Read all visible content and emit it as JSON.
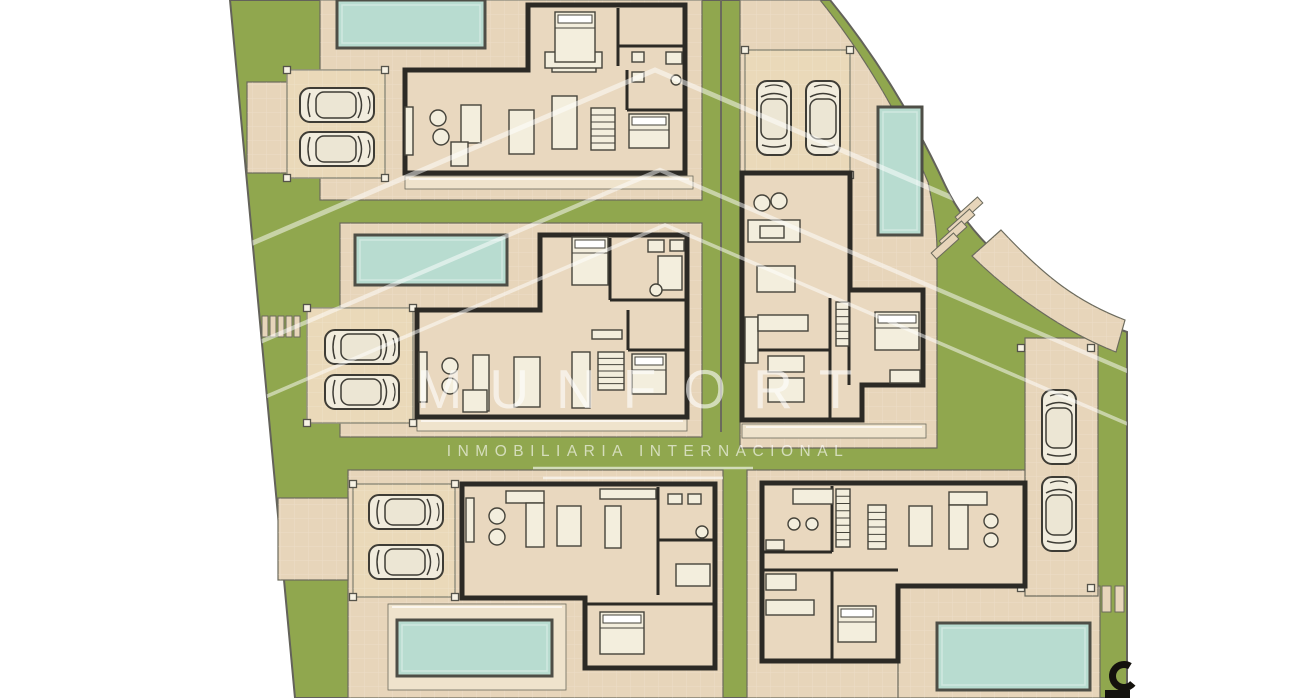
{
  "watermark": {
    "brand": "MUNFORT",
    "tagline": "INMOBILIARIA INTERNACIONAL",
    "chevrons": [
      [
        655,
        70
      ],
      [
        660,
        170
      ],
      [
        665,
        225
      ]
    ],
    "chevron_base_y": 430,
    "chevron_slope": 0.43,
    "underlines": [
      [
        533,
        468,
        753,
        468
      ],
      [
        543,
        478,
        723,
        478
      ]
    ]
  },
  "colors": {
    "white": "#ffffff",
    "lawn": "#90a74e",
    "pave": "#e7d5ba",
    "pave_light": "#efe3cc",
    "carport": "#ead9b9",
    "outline": "#6b6a5c",
    "site_edge": "#63625a",
    "wall": "#2c2a25",
    "floor": "#e9d8bf",
    "pool": "#b8dcd0",
    "pool_edge": "#4e4e46",
    "furn": "#f3eedd",
    "furn_edge": "#45433a",
    "car": "#f1ecdd",
    "car_roof": "#ece6d4",
    "car_edge": "#3e3c35",
    "palm_dark": "#3f5d28",
    "palm_mid": "#6d8a3c",
    "post": "#f7f2e4",
    "grid": "rgba(255,255,255,0.20)",
    "deck_line": "rgba(255,255,255,0.65)",
    "mark": "#14120d"
  },
  "site": {
    "outline_path": "M230,0 L830,0 C875,55 915,120 945,185 C975,250 1050,305 1127,332 L1127,698 L295,698 Z",
    "divider_lines": [
      [
        721,
        0,
        721,
        432
      ]
    ]
  },
  "pavements": [
    {
      "name": "terrace-top-left",
      "rect": [
        247,
        82,
        73,
        91
      ]
    },
    {
      "name": "plot-villa-1",
      "rect": [
        320,
        0,
        382,
        200
      ]
    },
    {
      "name": "plot-villa-2",
      "rect": [
        340,
        223,
        362,
        214
      ]
    },
    {
      "name": "plot-villa-3",
      "rect": [
        348,
        470,
        375,
        228
      ]
    },
    {
      "name": "terrace-villa-3",
      "rect": [
        278,
        498,
        70,
        82
      ]
    },
    {
      "name": "plot-villa-4",
      "path": "M740,0 L820,0 C862,52 900,115 928,182 C933,205 937,228 937,250 L937,448 L740,448 Z"
    },
    {
      "name": "plot-villa-5",
      "rect": [
        747,
        470,
        281,
        228
      ]
    },
    {
      "name": "pool-deck-villa-5",
      "rect": [
        898,
        586,
        202,
        112
      ]
    },
    {
      "name": "driveway",
      "rect": [
        1025,
        338,
        73,
        258
      ]
    },
    {
      "name": "road-curve",
      "path": "M972,256 L1001,230 C1046,278 1078,302 1125,320 L1116,352 C1064,332 1008,292 972,256 Z"
    }
  ],
  "decks": [
    {
      "rect": [
        405,
        176,
        288,
        13
      ]
    },
    {
      "rect": [
        417,
        418,
        270,
        13
      ]
    },
    {
      "rect": [
        742,
        424,
        184,
        14
      ]
    },
    {
      "rect": [
        388,
        604,
        178,
        86
      ]
    }
  ],
  "pools": [
    {
      "rect": [
        337,
        0,
        148,
        48
      ]
    },
    {
      "rect": [
        355,
        235,
        152,
        50
      ]
    },
    {
      "rect": [
        397,
        620,
        155,
        56
      ]
    },
    {
      "rect": [
        878,
        107,
        44,
        128
      ]
    },
    {
      "rect": [
        937,
        623,
        153,
        67
      ]
    }
  ],
  "carports": [
    {
      "rect": [
        287,
        70,
        98,
        108
      ]
    },
    {
      "rect": [
        307,
        308,
        106,
        115
      ]
    },
    {
      "rect": [
        353,
        484,
        102,
        113
      ]
    },
    {
      "rect": [
        745,
        50,
        105,
        125
      ]
    }
  ],
  "extra_posts": [
    [
      1021,
      348
    ],
    [
      1091,
      348
    ],
    [
      1021,
      588
    ],
    [
      1091,
      588
    ]
  ],
  "cars": [
    {
      "c": [
        337,
        105
      ],
      "rot": 0
    },
    {
      "c": [
        337,
        149
      ],
      "rot": 0
    },
    {
      "c": [
        362,
        347
      ],
      "rot": 0
    },
    {
      "c": [
        362,
        392
      ],
      "rot": 0
    },
    {
      "c": [
        406,
        512
      ],
      "rot": 0
    },
    {
      "c": [
        406,
        562
      ],
      "rot": 0
    },
    {
      "c": [
        774,
        118
      ],
      "rot": -90
    },
    {
      "c": [
        823,
        118
      ],
      "rot": -90
    },
    {
      "c": [
        1059,
        427
      ],
      "rot": -90
    },
    {
      "c": [
        1059,
        514
      ],
      "rot": -90
    }
  ],
  "houses": [
    {
      "name": "house-villa-1",
      "outline": "M405,70 L528,70 L528,5 L685,5 L685,173 L405,173 Z",
      "partitions": [
        [
          618,
          8,
          618,
          66
        ],
        [
          618,
          46,
          685,
          46
        ],
        [
          627,
          70,
          627,
          110
        ],
        [
          627,
          110,
          685,
          110
        ]
      ],
      "furniture": {
        "beds": [
          [
            555,
            12,
            40,
            50
          ],
          [
            629,
            114,
            40,
            34
          ]
        ],
        "rects": [
          [
            461,
            105,
            20,
            38
          ],
          [
            451,
            142,
            17,
            24
          ],
          [
            405,
            107,
            8,
            48
          ],
          [
            509,
            110,
            25,
            44
          ],
          [
            552,
            96,
            25,
            53
          ],
          [
            632,
            52,
            12,
            10
          ],
          [
            632,
            72,
            12,
            10
          ],
          [
            666,
            52,
            16,
            12
          ],
          [
            552,
            64,
            44,
            8
          ],
          [
            545,
            52,
            57,
            16
          ]
        ],
        "stripes": [
          [
            591,
            108,
            24,
            42,
            6
          ]
        ],
        "circles": [
          [
            438,
            118,
            8
          ],
          [
            441,
            137,
            8
          ],
          [
            676,
            80,
            5
          ]
        ]
      }
    },
    {
      "name": "house-villa-2",
      "outline": "M417,310 L540,310 L540,235 L687,235 L687,417 L417,417 Z",
      "partitions": [
        [
          610,
          238,
          610,
          300
        ],
        [
          610,
          300,
          687,
          300
        ],
        [
          628,
          310,
          628,
          350
        ],
        [
          628,
          350,
          687,
          350
        ]
      ],
      "furniture": {
        "beds": [
          [
            572,
            237,
            36,
            48
          ],
          [
            632,
            354,
            34,
            40
          ]
        ],
        "rects": [
          [
            419,
            352,
            8,
            50
          ],
          [
            473,
            355,
            16,
            56
          ],
          [
            463,
            390,
            24,
            22
          ],
          [
            514,
            357,
            26,
            50
          ],
          [
            572,
            352,
            18,
            56
          ],
          [
            592,
            330,
            30,
            9
          ],
          [
            648,
            240,
            16,
            12
          ],
          [
            670,
            240,
            14,
            11
          ],
          [
            658,
            256,
            24,
            34
          ]
        ],
        "stripes": [
          [
            598,
            352,
            26,
            38,
            6
          ]
        ],
        "circles": [
          [
            450,
            366,
            8
          ],
          [
            450,
            386,
            8
          ],
          [
            656,
            290,
            6
          ]
        ]
      }
    },
    {
      "name": "house-villa-3",
      "outline": "M462,484 L715,484 L715,668 L585,668 L585,598 L462,598 Z",
      "partitions": [
        [
          658,
          487,
          658,
          595
        ],
        [
          658,
          540,
          715,
          540
        ],
        [
          585,
          604,
          715,
          604
        ]
      ],
      "furniture": {
        "beds": [
          [
            600,
            612,
            44,
            42
          ]
        ],
        "rects": [
          [
            466,
            498,
            8,
            44
          ],
          [
            506,
            491,
            38,
            12
          ],
          [
            526,
            503,
            18,
            44
          ],
          [
            557,
            506,
            24,
            40
          ],
          [
            605,
            506,
            16,
            42
          ],
          [
            600,
            489,
            56,
            10
          ],
          [
            668,
            494,
            14,
            10
          ],
          [
            688,
            494,
            13,
            10
          ],
          [
            676,
            564,
            34,
            22
          ]
        ],
        "stripes": [],
        "circles": [
          [
            497,
            516,
            8
          ],
          [
            497,
            537,
            8
          ],
          [
            702,
            532,
            6
          ]
        ]
      }
    },
    {
      "name": "house-villa-4",
      "outline": "M742,173 L850,173 L850,290 L923,290 L923,385 L862,385 L862,420 L742,420 Z",
      "partitions": [
        [
          830,
          298,
          830,
          420
        ],
        [
          742,
          350,
          830,
          350
        ],
        [
          849,
          290,
          849,
          385
        ]
      ],
      "furniture": {
        "beds": [
          [
            875,
            312,
            44,
            38
          ]
        ],
        "rects": [
          [
            748,
            220,
            52,
            22
          ],
          [
            760,
            226,
            24,
            12
          ],
          [
            757,
            266,
            38,
            26
          ],
          [
            745,
            317,
            13,
            46
          ],
          [
            758,
            315,
            50,
            16
          ],
          [
            768,
            356,
            36,
            16
          ],
          [
            768,
            378,
            36,
            24
          ],
          [
            890,
            370,
            30,
            13
          ]
        ],
        "stripes": [
          [
            836,
            302,
            13,
            44,
            6
          ]
        ],
        "circles": [
          [
            762,
            203,
            8
          ],
          [
            779,
            201,
            8
          ]
        ]
      }
    },
    {
      "name": "house-villa-5",
      "outline": "M762,483 L1025,483 L1025,586 L898,586 L898,661 L762,661 Z",
      "partitions": [
        [
          832,
          486,
          832,
          552
        ],
        [
          762,
          552,
          832,
          552
        ],
        [
          762,
          570,
          898,
          570
        ],
        [
          832,
          570,
          832,
          661
        ]
      ],
      "furniture": {
        "beds": [
          [
            838,
            606,
            38,
            36
          ]
        ],
        "rects": [
          [
            793,
            489,
            40,
            15
          ],
          [
            766,
            540,
            18,
            10
          ],
          [
            766,
            600,
            48,
            15
          ],
          [
            766,
            574,
            30,
            16
          ],
          [
            909,
            506,
            23,
            40
          ],
          [
            949,
            492,
            38,
            13
          ],
          [
            949,
            505,
            19,
            44
          ]
        ],
        "stripes": [
          [
            836,
            489,
            14,
            58,
            8
          ],
          [
            868,
            505,
            18,
            44,
            6
          ]
        ],
        "circles": [
          [
            991,
            521,
            7
          ],
          [
            991,
            540,
            7
          ],
          [
            794,
            524,
            6
          ],
          [
            812,
            524,
            6
          ]
        ]
      }
    }
  ],
  "steps": {
    "left_bars": {
      "xs": [
        262,
        270,
        278,
        286,
        294
      ],
      "y": 316,
      "w": 6,
      "h": 21
    },
    "curve_bars": {
      "centers": [
        [
          969,
          210
        ],
        [
          961,
          222
        ],
        [
          953,
          234
        ],
        [
          945,
          246
        ]
      ],
      "w": 30,
      "h": 8,
      "rot": -42
    },
    "gate_bars": [
      [
        1102,
        586,
        9,
        26
      ],
      [
        1115,
        586,
        9,
        26
      ]
    ]
  },
  "palms": [
    {
      "c": [
        260,
        16
      ],
      "s": 1.0
    },
    {
      "c": [
        281,
        258
      ],
      "s": 1.0
    },
    {
      "c": [
        297,
        460
      ],
      "s": 1.0
    },
    {
      "c": [
        322,
        656
      ],
      "s": 1.05
    },
    {
      "c": [
        672,
        218
      ],
      "s": 1.05
    },
    {
      "c": [
        728,
        514
      ],
      "s": 1.0
    },
    {
      "c": [
        975,
        268
      ],
      "s": 0.95
    },
    {
      "c": [
        992,
        404
      ],
      "s": 0.9
    },
    {
      "c": [
        1122,
        348
      ],
      "s": 0.85
    },
    {
      "c": [
        1121,
        506
      ],
      "s": 0.8
    }
  ],
  "corner_mark": {
    "circle": [
      1124,
      676,
      11.5
    ],
    "rect": [
      1105,
      690,
      25,
      8
    ]
  }
}
